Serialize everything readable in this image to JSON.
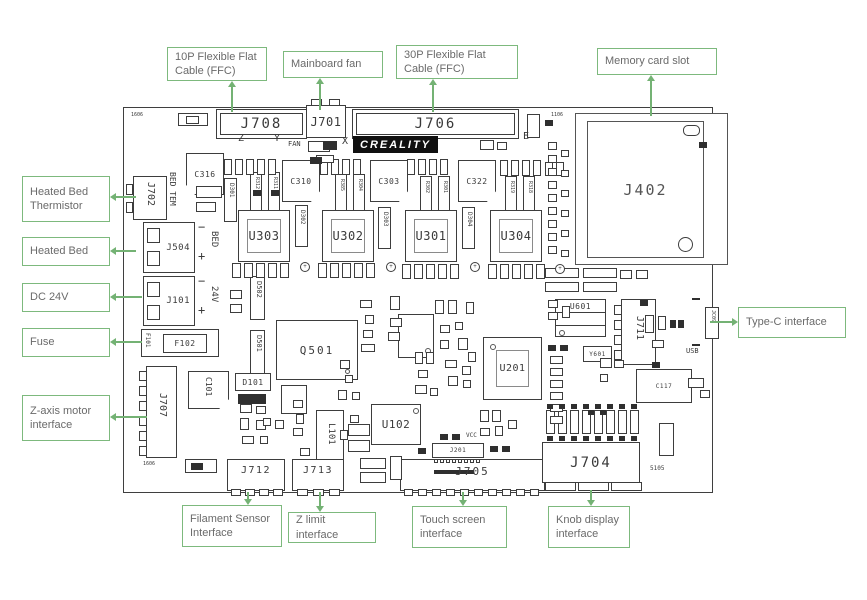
{
  "callouts": {
    "ffc_10p": "10P Flexible Flat\nCable (FFC)",
    "mainboard_fan": "Mainboard fan",
    "ffc_30p": "30P Flexible Flat\nCable (FFC)",
    "memory_card": "Memory card slot",
    "heated_bed_thermistor": "Heated Bed\nThermistor",
    "heated_bed": "Heated Bed",
    "dc_24v": "DC 24V",
    "fuse": "Fuse",
    "z_axis_motor": "Z-axis motor\ninterface",
    "type_c": "Type-C interface",
    "filament_sensor": "Filament Sensor\nInterface",
    "z_limit": "Z limit interface",
    "touch_screen": "Touch screen\ninterface",
    "knob_display": "Knob display\ninterface"
  },
  "board": {
    "logo": "CREALITY",
    "connectors": {
      "j708": "J708",
      "j701": "J701",
      "j706": "J706",
      "j402": "J402",
      "j702": "J702",
      "j504": "J504",
      "j101": "J101",
      "j707": "J707",
      "j711": "J711",
      "j712": "J712",
      "j713": "J713",
      "j705": "J705",
      "j704": "J704",
      "j201": "J201",
      "jc09": "JC09"
    },
    "fuse": {
      "f101": "F101",
      "f102": "F102"
    },
    "drivers": {
      "u303": "U303",
      "u302": "U302",
      "u301": "U301",
      "u304": "U304"
    },
    "caps": {
      "c316": "C316",
      "c310": "C310",
      "c303": "C303",
      "c322": "C322",
      "c101": "C101",
      "c117": "C117"
    },
    "ics": {
      "q501": "Q501",
      "u201": "U201",
      "u102": "U102",
      "u601": "U601",
      "y601": "Y601",
      "l101": "L101"
    },
    "diodes": {
      "d101": "D101",
      "d301": "D301",
      "d302": "D302",
      "d303": "D303",
      "d304": "D304",
      "d501": "D501",
      "d502": "D502"
    },
    "resistors": {
      "r312": "R312",
      "r311": "R311",
      "r385": "R385",
      "r304": "R304",
      "r302": "R302",
      "r301": "R301",
      "r319": "R319",
      "r318": "R318"
    },
    "texts": {
      "axis_z": "Z",
      "axis_y": "Y",
      "fan": "FAN",
      "axis_x": "X",
      "axis_e": "E",
      "bed_tem": "BED TEM",
      "bed": "BED",
      "v24": "24V",
      "usb": "USB",
      "vcc": "VCC",
      "minus": "−",
      "plus": "+",
      "ref_5105": "5105",
      "ref_1606": "1606",
      "ref_1106": "1106"
    }
  },
  "colors": {
    "accent_green": "#7db97d",
    "line": "#3d3d3d",
    "logo_bg": "#101010"
  }
}
